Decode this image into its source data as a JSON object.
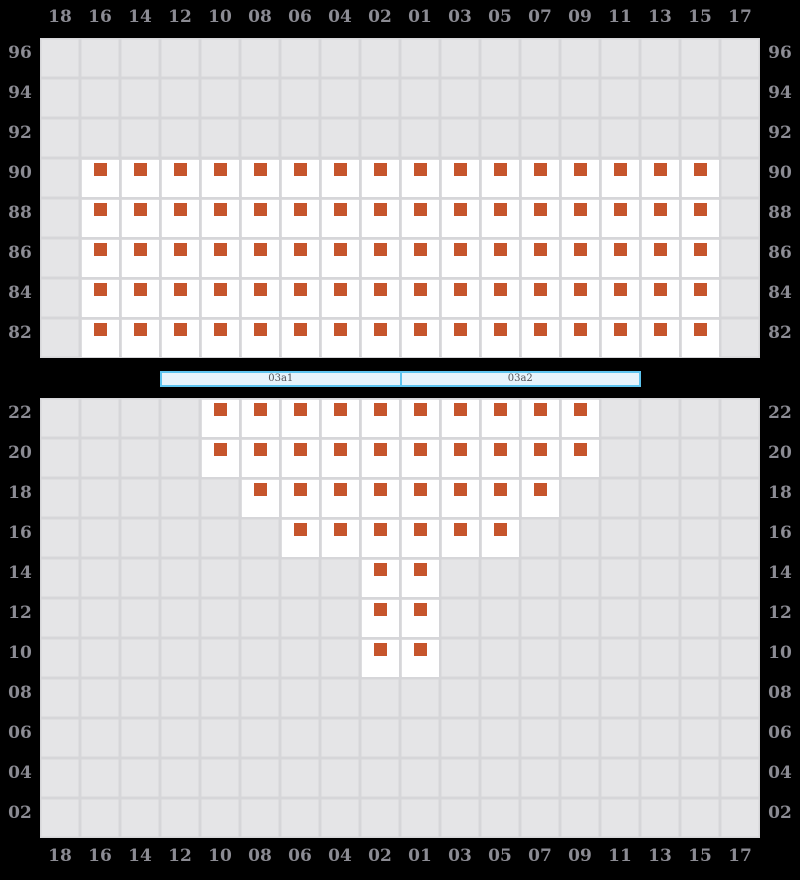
{
  "colors": {
    "page_bg": "#000000",
    "grid_bg": "#e5e5e7",
    "grid_line": "#d6d6d9",
    "seat_fill": "#ffffff",
    "marker": "#c6552c",
    "axis_text": "#8b8b93",
    "bar_fill": "#e6f3fb",
    "bar_border": "#5ec4ef",
    "bar_text": "#505055"
  },
  "top_axis": {
    "labels": [
      "18",
      "16",
      "14",
      "12",
      "10",
      "08",
      "06",
      "04",
      "02",
      "01",
      "03",
      "05",
      "07",
      "09",
      "11",
      "13",
      "15",
      "17"
    ]
  },
  "bottom_axis": {
    "labels": [
      "18",
      "16",
      "14",
      "12",
      "10",
      "08",
      "06",
      "04",
      "02",
      "01",
      "03",
      "05",
      "07",
      "09",
      "11",
      "13",
      "15",
      "17"
    ]
  },
  "divider": {
    "sections": [
      {
        "label": "03a1"
      },
      {
        "label": "03a2"
      }
    ]
  },
  "upper_block": {
    "row_labels": [
      "96",
      "94",
      "92",
      "90",
      "88",
      "86",
      "84",
      "82"
    ],
    "seat_rows": [
      {
        "row": "90",
        "cols": [
          "16",
          "14",
          "12",
          "10",
          "08",
          "06",
          "04",
          "02",
          "01",
          "03",
          "05",
          "07",
          "09",
          "11",
          "13",
          "15"
        ]
      },
      {
        "row": "88",
        "cols": [
          "16",
          "14",
          "12",
          "10",
          "08",
          "06",
          "04",
          "02",
          "01",
          "03",
          "05",
          "07",
          "09",
          "11",
          "13",
          "15"
        ]
      },
      {
        "row": "86",
        "cols": [
          "16",
          "14",
          "12",
          "10",
          "08",
          "06",
          "04",
          "02",
          "01",
          "03",
          "05",
          "07",
          "09",
          "11",
          "13",
          "15"
        ]
      },
      {
        "row": "84",
        "cols": [
          "16",
          "14",
          "12",
          "10",
          "08",
          "06",
          "04",
          "02",
          "01",
          "03",
          "05",
          "07",
          "09",
          "11",
          "13",
          "15"
        ]
      },
      {
        "row": "82",
        "cols": [
          "16",
          "14",
          "12",
          "10",
          "08",
          "06",
          "04",
          "02",
          "01",
          "03",
          "05",
          "07",
          "09",
          "11",
          "13",
          "15"
        ]
      }
    ]
  },
  "lower_block": {
    "row_labels": [
      "22",
      "20",
      "18",
      "16",
      "14",
      "12",
      "10",
      "08",
      "06",
      "04",
      "02"
    ],
    "seat_rows": [
      {
        "row": "22",
        "cols": [
          "10",
          "08",
          "06",
          "04",
          "02",
          "01",
          "03",
          "05",
          "07",
          "09"
        ]
      },
      {
        "row": "20",
        "cols": [
          "10",
          "08",
          "06",
          "04",
          "02",
          "01",
          "03",
          "05",
          "07",
          "09"
        ]
      },
      {
        "row": "18",
        "cols": [
          "08",
          "06",
          "04",
          "02",
          "01",
          "03",
          "05",
          "07"
        ]
      },
      {
        "row": "16",
        "cols": [
          "06",
          "04",
          "02",
          "01",
          "03",
          "05"
        ]
      },
      {
        "row": "14",
        "cols": [
          "02",
          "01"
        ]
      },
      {
        "row": "12",
        "cols": [
          "02",
          "01"
        ]
      },
      {
        "row": "10",
        "cols": [
          "02",
          "01"
        ]
      }
    ]
  }
}
